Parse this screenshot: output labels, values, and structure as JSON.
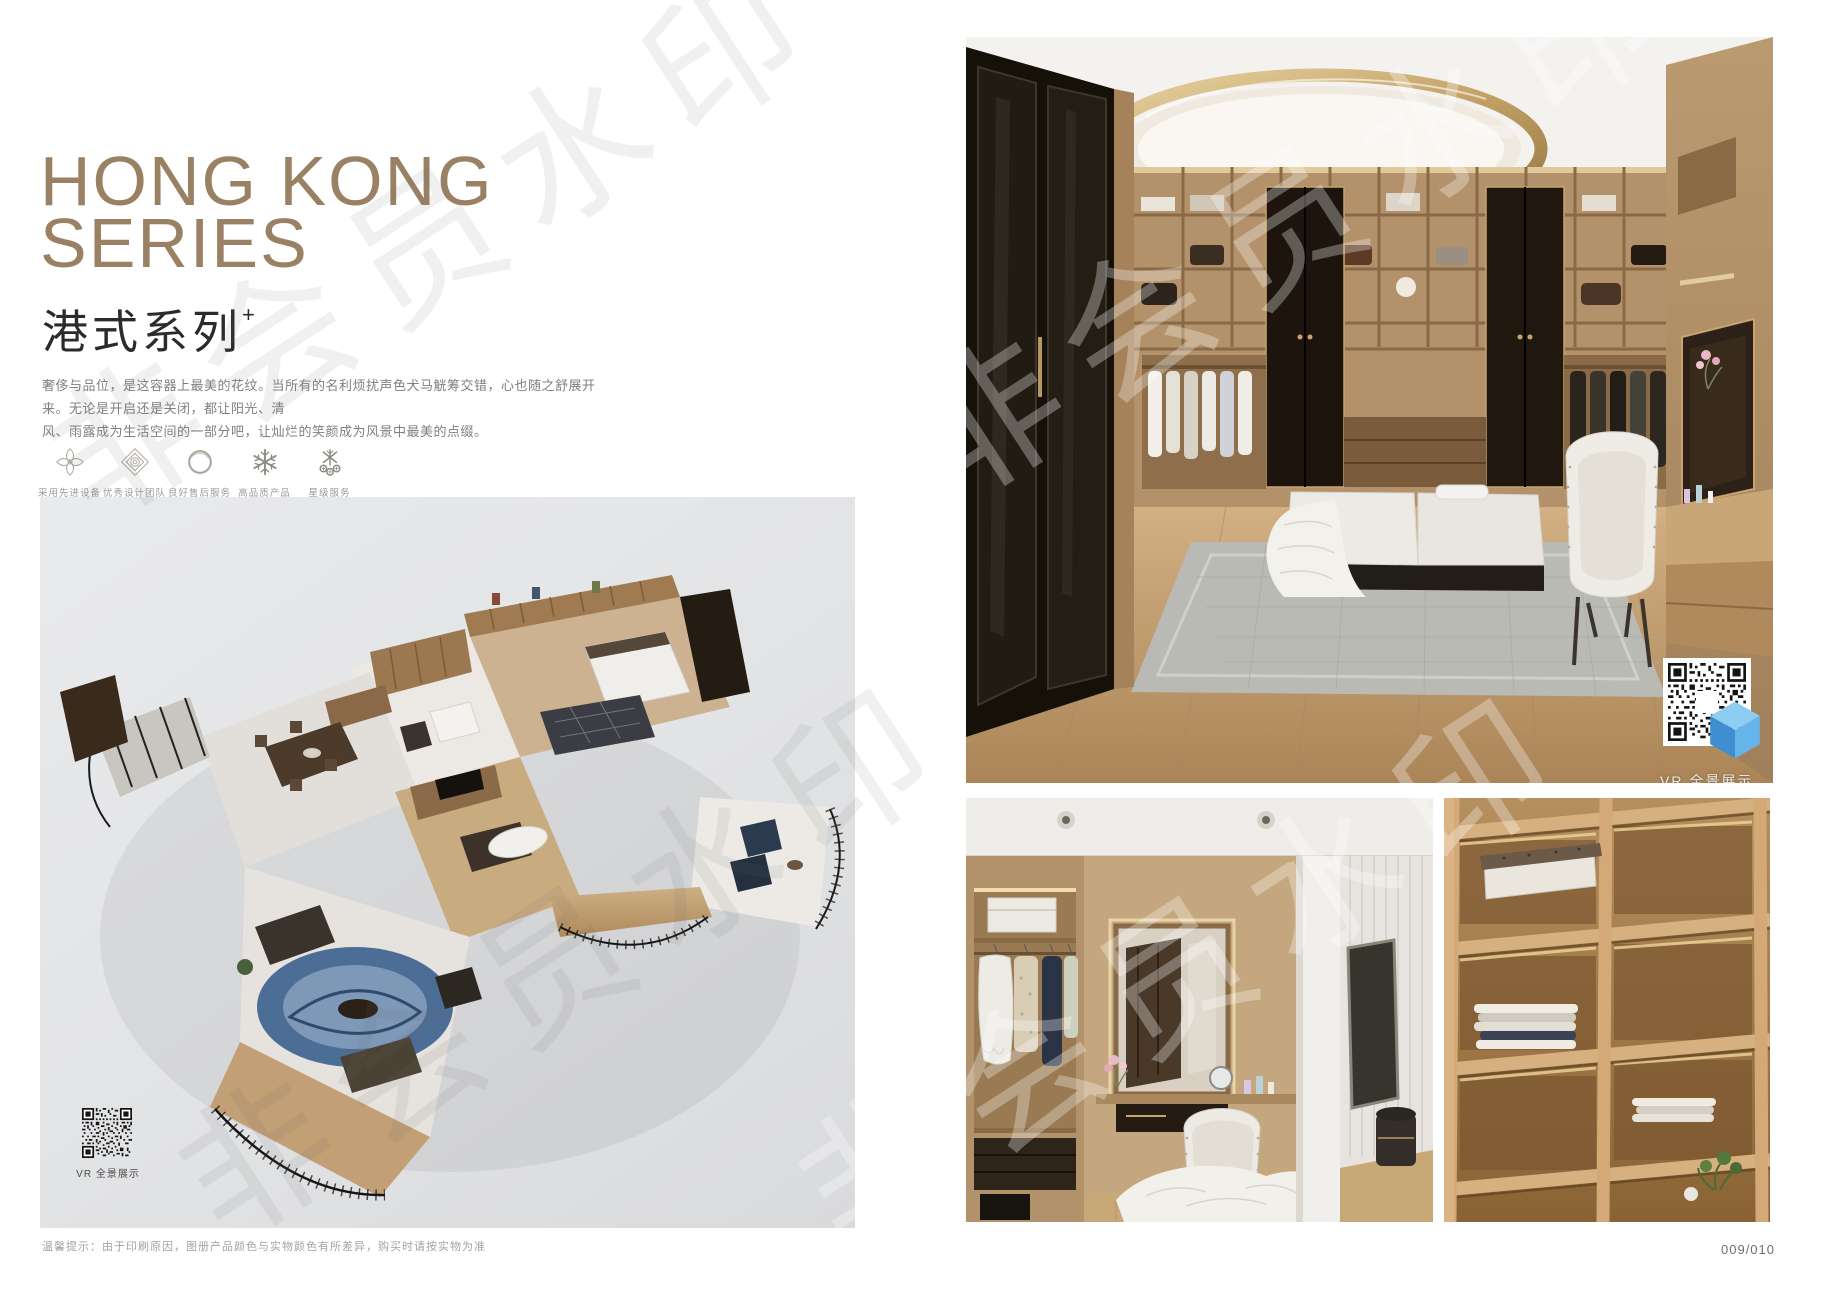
{
  "watermark": {
    "text": "非会员水印"
  },
  "left_page": {
    "title_line1": "HONG KONG",
    "title_line2": "SERIES",
    "subtitle": "港式系列",
    "subtitle_mark": "+",
    "intro_line1": "奢侈与品位，是这容器上最美的花纹。当所有的名利烦扰声色犬马觥筹交错，心也随之舒展开来。无论是开启还是关闭，都让阳光、清",
    "intro_line2": "风、雨露成为生活空间的一部分吧，让灿烂的笑颜成为风景中最美的点缀。",
    "features": [
      {
        "icon": "flower-ornament-icon",
        "label": "采用先进设备"
      },
      {
        "icon": "diamond-ornament-icon",
        "label": "优秀设计团队"
      },
      {
        "icon": "ring-icon",
        "label": "良好售后服务"
      },
      {
        "icon": "snowflake-icon",
        "label": "高品质产品"
      },
      {
        "icon": "star-service-icon",
        "label": "星级服务"
      }
    ],
    "floorplan_qr_caption": "VR 全景展示"
  },
  "right_page": {
    "main_photo_qr_caption": "VR 全景展示"
  },
  "footer": {
    "note": "温馨提示：由于印刷原因，图册产品颜色与实物颜色有所差异，购买时请按实物为准",
    "page_number": "009/010"
  },
  "colors": {
    "title_bronze": "#9a8164",
    "qr_cube_blue": "#4a9fdc"
  }
}
